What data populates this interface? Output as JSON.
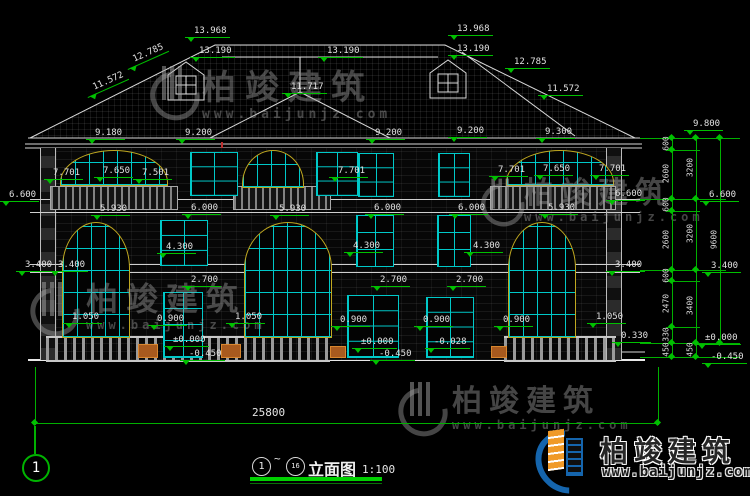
{
  "watermark": {
    "brand": "柏竣建筑",
    "url": "www.baijunjz.com"
  },
  "logo": {
    "brand": "柏竣建筑",
    "url": "www.baijunjz.com"
  },
  "axis": {
    "left": "1"
  },
  "titlebar": {
    "start": "1",
    "tilde": "~",
    "end": "16",
    "name": "立面图",
    "scale": "1:100"
  },
  "dims": {
    "total": "25800",
    "top": [
      "13.968",
      "13.190",
      "13.190",
      "13.968",
      "13.190",
      "12.785",
      "11.572",
      "11.717",
      "12.785",
      "11.572"
    ],
    "eave": [
      "9.180",
      "9.200",
      "9.200",
      "9.200",
      "9.300"
    ],
    "f3": [
      "7.701",
      "7.650",
      "7.501",
      "7.701",
      "7.701",
      "7.650",
      "7.701"
    ],
    "b66": [
      "6.600",
      "6.600"
    ],
    "f2": [
      "5.930",
      "6.000",
      "5.930",
      "6.000",
      "6.000",
      "5.930"
    ],
    "m43": [
      "4.300",
      "4.300",
      "4.300"
    ],
    "m34": [
      "3.400",
      "3.400",
      "3.400"
    ],
    "m27": [
      "2.700",
      "2.700",
      "2.700"
    ],
    "sill": [
      "1.050",
      "0.900",
      "1.050",
      "0.900",
      "0.900",
      "0.900",
      "1.050",
      "0.330"
    ],
    "ground": [
      "±0.000",
      "-0.450",
      "±0.000",
      "-0.450",
      "-0.028"
    ]
  },
  "chain": {
    "elev": [
      "9.800",
      "6.600",
      "3.400",
      "±0.000",
      "-0.450"
    ],
    "inner": [
      "600",
      "2600",
      "600",
      "2600",
      "600",
      "2470",
      "330",
      "450"
    ],
    "mid": [
      "3200",
      "3200",
      "3400",
      "450"
    ],
    "outer": "9600"
  }
}
